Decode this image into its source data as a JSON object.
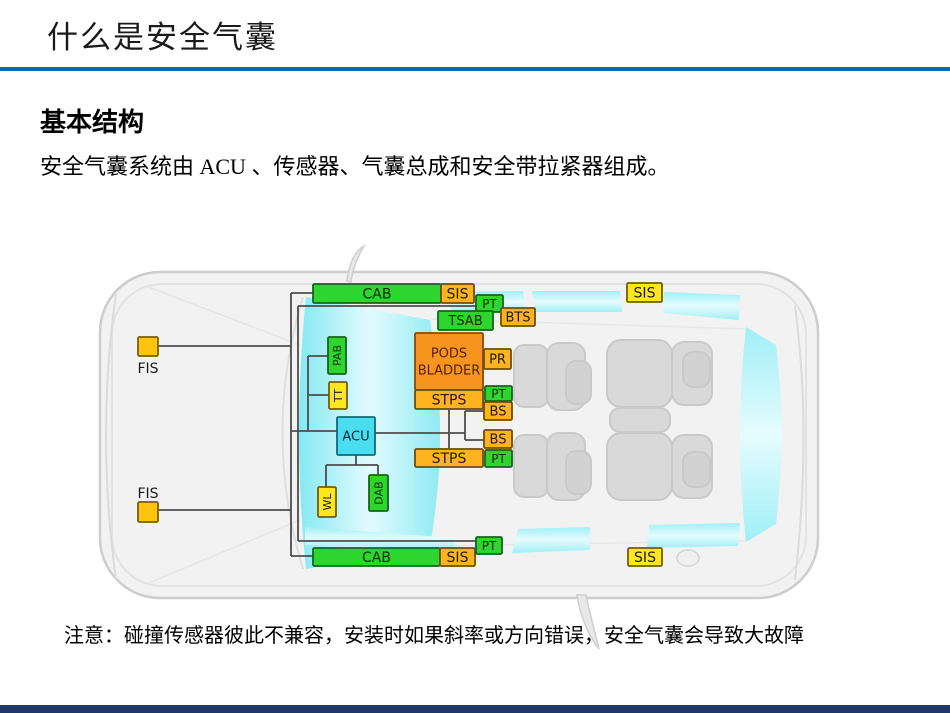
{
  "slide": {
    "title": "什么是安全气囊",
    "section_heading": "基本结构",
    "body_text": "安全气囊系统由 ACU 、传感器、气囊总成和安全带拉紧器组成。",
    "note_text": "注意：碰撞传感器彼此不兼容，安装时如果斜率或方向错误，安全气囊会导致大故障",
    "accent_rule_color": "#1065C0",
    "footer_bar_color": "#1F3864"
  },
  "diagram": {
    "palette": {
      "green": {
        "fill": "#2ED52E",
        "stroke": "#14641A",
        "text": "#102800"
      },
      "yellow": {
        "fill": "#FFE71F",
        "stroke": "#6F6000",
        "text": "#1A1A1A"
      },
      "amber": {
        "fill": "#FFB31E",
        "stroke": "#6F4E00",
        "text": "#1A1A1A"
      },
      "gold": {
        "fill": "#FFC40E",
        "stroke": "#7A5E00",
        "text": "#1A1A1A"
      },
      "orange": {
        "fill": "#F6941E",
        "stroke": "#8A4A00",
        "text": "#571F00"
      },
      "cyan": {
        "fill": "#4ADDF0",
        "stroke": "#0C6B7A",
        "text": "#0B2B33"
      }
    },
    "line_color": "#4D4D4D",
    "nodes": [
      {
        "id": "cab-top",
        "label": "CAB",
        "color": "green",
        "x": 313,
        "y": 284,
        "w": 128,
        "h": 19,
        "fs": 14
      },
      {
        "id": "sis-top-left",
        "label": "SIS",
        "color": "amber",
        "x": 441,
        "y": 284,
        "w": 33,
        "h": 19,
        "fs": 14
      },
      {
        "id": "pt-top",
        "label": "PT",
        "color": "green",
        "x": 476,
        "y": 295,
        "w": 27,
        "h": 17,
        "fs": 12
      },
      {
        "id": "tsab",
        "label": "TSAB",
        "color": "green",
        "x": 438,
        "y": 311,
        "w": 55,
        "h": 19,
        "fs": 13
      },
      {
        "id": "bts",
        "label": "BTS",
        "color": "amber",
        "x": 501,
        "y": 308,
        "w": 34,
        "h": 18,
        "fs": 13
      },
      {
        "id": "sis-top-right",
        "label": "SIS",
        "color": "yellow",
        "x": 627,
        "y": 283,
        "w": 35,
        "h": 19,
        "fs": 14
      },
      {
        "id": "fis-front",
        "label": "FIS",
        "color": "gold",
        "x": 138,
        "y": 337,
        "w": 20,
        "h": 19,
        "fs": 14,
        "labelPos": "below"
      },
      {
        "id": "pab",
        "label": "PAB",
        "color": "green",
        "x": 328,
        "y": 337,
        "w": 18,
        "h": 37,
        "fs": 11,
        "vertical": true
      },
      {
        "id": "tt",
        "label": "TT",
        "color": "yellow",
        "x": 329,
        "y": 382,
        "w": 18,
        "h": 27,
        "fs": 11,
        "vertical": true
      },
      {
        "id": "pods-bladder",
        "label": "PODS\nBLADDER",
        "color": "orange",
        "x": 415,
        "y": 333,
        "w": 68,
        "h": 57,
        "fs": 13
      },
      {
        "id": "pr",
        "label": "PR",
        "color": "amber",
        "x": 484,
        "y": 349,
        "w": 27,
        "h": 20,
        "fs": 13
      },
      {
        "id": "stps-top",
        "label": "STPS",
        "color": "amber",
        "x": 415,
        "y": 390,
        "w": 68,
        "h": 19,
        "fs": 14
      },
      {
        "id": "pt-mid-top",
        "label": "PT",
        "color": "green",
        "x": 485,
        "y": 386,
        "w": 27,
        "h": 15,
        "fs": 12
      },
      {
        "id": "bs-top",
        "label": "BS",
        "color": "amber",
        "x": 484,
        "y": 402,
        "w": 28,
        "h": 18,
        "fs": 13
      },
      {
        "id": "acu",
        "label": "ACU",
        "color": "cyan",
        "x": 337,
        "y": 417,
        "w": 38,
        "h": 38,
        "fs": 13
      },
      {
        "id": "bs-mid",
        "label": "BS",
        "color": "amber",
        "x": 484,
        "y": 430,
        "w": 28,
        "h": 18,
        "fs": 13
      },
      {
        "id": "stps-bottom",
        "label": "STPS",
        "color": "amber",
        "x": 415,
        "y": 449,
        "w": 68,
        "h": 18,
        "fs": 14
      },
      {
        "id": "pt-mid-bottom",
        "label": "PT",
        "color": "green",
        "x": 485,
        "y": 450,
        "w": 27,
        "h": 17,
        "fs": 12
      },
      {
        "id": "dab",
        "label": "DAB",
        "color": "green",
        "x": 369,
        "y": 475,
        "w": 19,
        "h": 36,
        "fs": 11,
        "vertical": true
      },
      {
        "id": "wl",
        "label": "WL",
        "color": "yellow",
        "x": 318,
        "y": 487,
        "w": 18,
        "h": 30,
        "fs": 11,
        "vertical": true
      },
      {
        "id": "fis-rear",
        "label": "FIS",
        "color": "gold",
        "x": 138,
        "y": 502,
        "w": 20,
        "h": 20,
        "fs": 14,
        "labelPos": "above"
      },
      {
        "id": "cab-bottom",
        "label": "CAB",
        "color": "green",
        "x": 313,
        "y": 548,
        "w": 127,
        "h": 18,
        "fs": 14
      },
      {
        "id": "sis-bottom-left",
        "label": "SIS",
        "color": "amber",
        "x": 440,
        "y": 548,
        "w": 35,
        "h": 18,
        "fs": 14
      },
      {
        "id": "pt-bottom",
        "label": "PT",
        "color": "green",
        "x": 476,
        "y": 537,
        "w": 26,
        "h": 17,
        "fs": 12
      },
      {
        "id": "sis-bottom-right",
        "label": "SIS",
        "color": "yellow",
        "x": 628,
        "y": 548,
        "w": 34,
        "h": 18,
        "fs": 14
      }
    ]
  }
}
